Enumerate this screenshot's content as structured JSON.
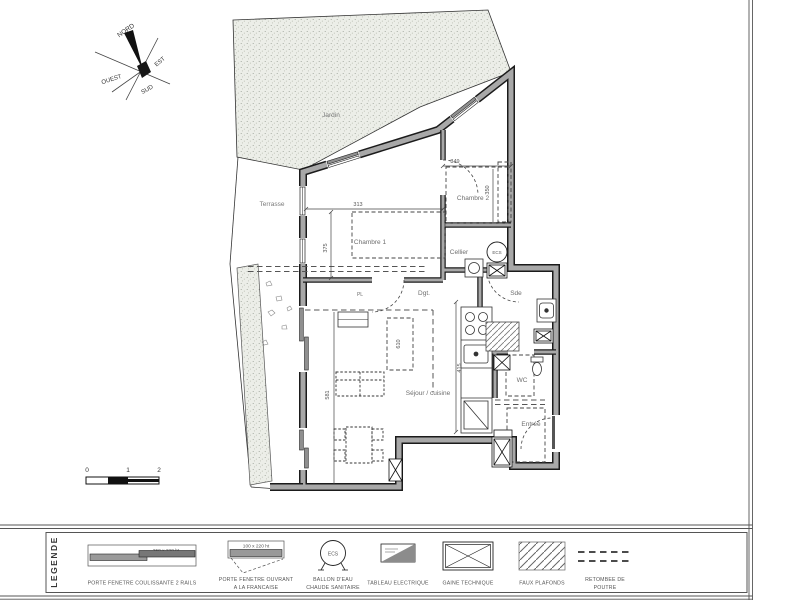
{
  "compass": {
    "north": "NORD",
    "east": "EST",
    "south": "SUD",
    "west": "OUEST"
  },
  "plan": {
    "garden_label": "Jardin",
    "terrace_label": "Terrasse",
    "rooms": {
      "chambre1": "Chambre 1",
      "chambre2": "Chambre 2",
      "cellier": "Cellier",
      "degagement": "Dgt.",
      "salle_eau": "Sde",
      "sejour_cuisine": "Séjour / cuisine",
      "wc": "WC",
      "entree": "Entrée",
      "placard": "PL"
    },
    "boiler_label": "ECS",
    "dimensions": {
      "ch1_width": "313",
      "ch1_depth": "375",
      "ch2_width": "349",
      "ch2_depth": "350",
      "sejour_ceiling": "610",
      "kitchen_depth": "415",
      "sejour_depth": "581"
    }
  },
  "scale_bar": {
    "ticks": [
      "0",
      "1",
      "2"
    ]
  },
  "legend": {
    "title": "LEGENDE",
    "items": [
      {
        "size": "250 x 220 ht",
        "caption": "PORTE FENETRE COULISSANTE 2 RAILS"
      },
      {
        "size": "100 x 220 ht",
        "caption1": "PORTE FENETRE OUVRANT",
        "caption2": "A LA FRANCAISE"
      },
      {
        "badge": "ECS",
        "caption1": "BALLON D'EAU",
        "caption2": "CHAUDE SANITAIRE"
      },
      {
        "caption": "TABLEAU ELECTRIQUE"
      },
      {
        "caption": "GAINE TECHNIQUE"
      },
      {
        "caption": "FAUX PLAFONDS"
      },
      {
        "caption1": "RETOMBEE DE",
        "caption2": "POUTRE"
      }
    ]
  },
  "colors": {
    "wall": "#a8a8a8",
    "line": "#1c1c1c",
    "garden_fill": "#eceee8",
    "label_gray": "#6e6e6e"
  }
}
